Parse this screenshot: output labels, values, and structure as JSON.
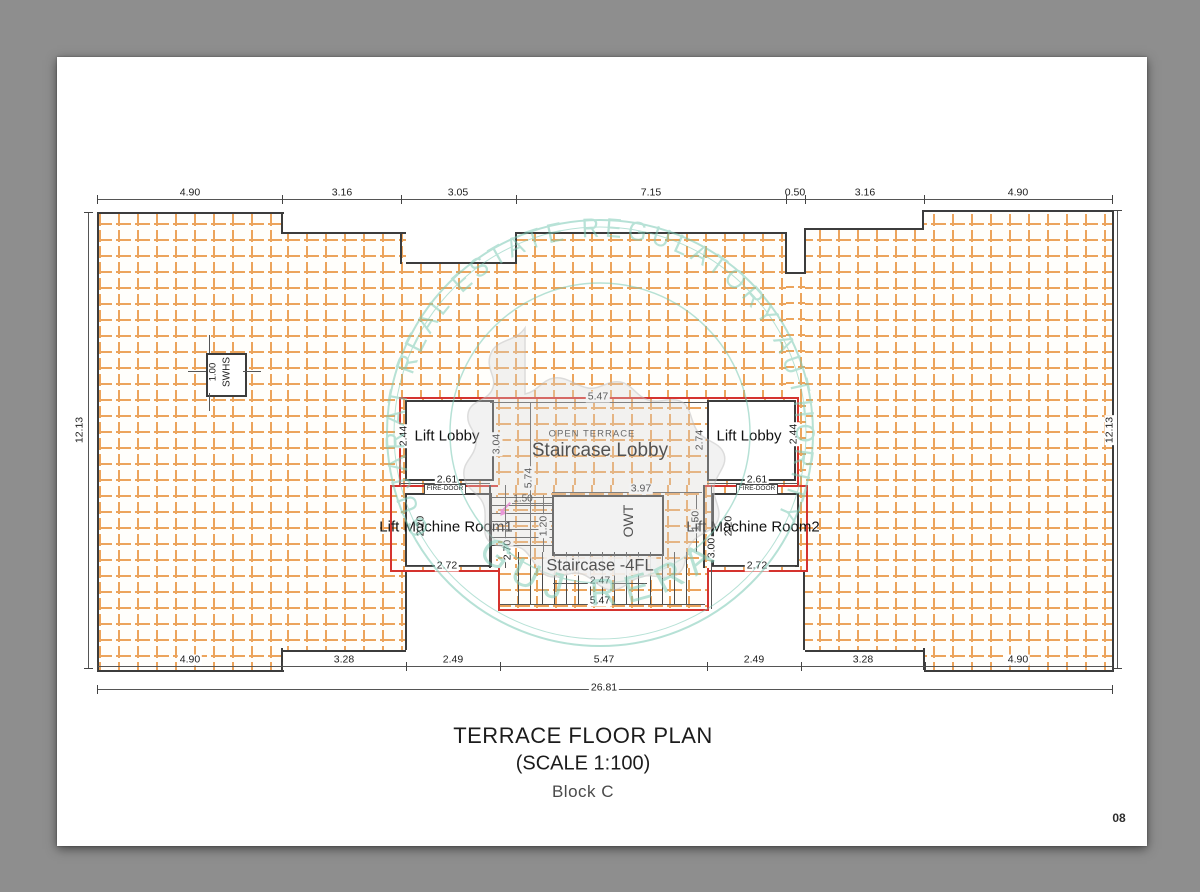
{
  "page": {
    "number": "08"
  },
  "title": {
    "line1": "TERRACE FLOOR PLAN",
    "line2": "(SCALE 1:100)",
    "line3": "Block C"
  },
  "watermark": {
    "arc_text": "GUJARAT REAL ESTATE REGULATORY AUTHORITY",
    "bottom_text": "GUJ RERA",
    "teal": "#7ccab5",
    "map_gray": "#d7d7d7"
  },
  "colors": {
    "hatch_orange": "#eca45c",
    "outline_red": "#d5332e",
    "wall_dark": "#3c3c3c",
    "page_bg": "#ffffff",
    "desk_bg": "#8e8e8e",
    "marker_pink": "#f277d6"
  },
  "rooms": {
    "lift_lobby_left": "Lift Lobby",
    "lift_lobby_right": "Lift Lobby",
    "open_terrace": "OPEN TERRACE",
    "staircase_lobby": "Staircase Lobby",
    "owt": "OWT",
    "staircase_4fl": "Staircase -4FL",
    "machine_room_1": "Lift Machine Room1",
    "machine_room_2": "Lift Machine Room2",
    "swhs": "SWHS",
    "fire_door_left": "FIRE-DOOR",
    "fire_door_right": "FIRE-DOOR"
  },
  "dims": {
    "top": [
      "4.90",
      "3.16",
      "3.05",
      "7.15",
      "0.50",
      "3.16",
      "4.90"
    ],
    "bottom": [
      "4.90",
      "3.28",
      "2.49",
      "5.47",
      "2.49",
      "3.28",
      "4.90"
    ],
    "total_width": "26.81",
    "side_left": "12.13",
    "side_right": "12.13",
    "core_top_width": "5.47",
    "lobby_left_h": "2.44",
    "lobby_right_h": "2.44",
    "stair_lobby_left_h": "3.04",
    "stair_lobby_right_h": "2.74",
    "fire_span_left": "2.61",
    "fire_span_right": "2.61",
    "mr1_width": "2.72",
    "mr2_width": "2.72",
    "mr1_height": "2.20",
    "mr2_height": "2.20",
    "core_height": "5.74",
    "flight_width": "1.50",
    "flight_height": "1.20",
    "stair_left_h": "2.70",
    "owt_width": "3.97",
    "owt_right_h": "1.50",
    "stair_right_h": "3.00",
    "tread_width": "2.47",
    "stair_block_width": "5.47",
    "swhs_size": "1.00"
  }
}
